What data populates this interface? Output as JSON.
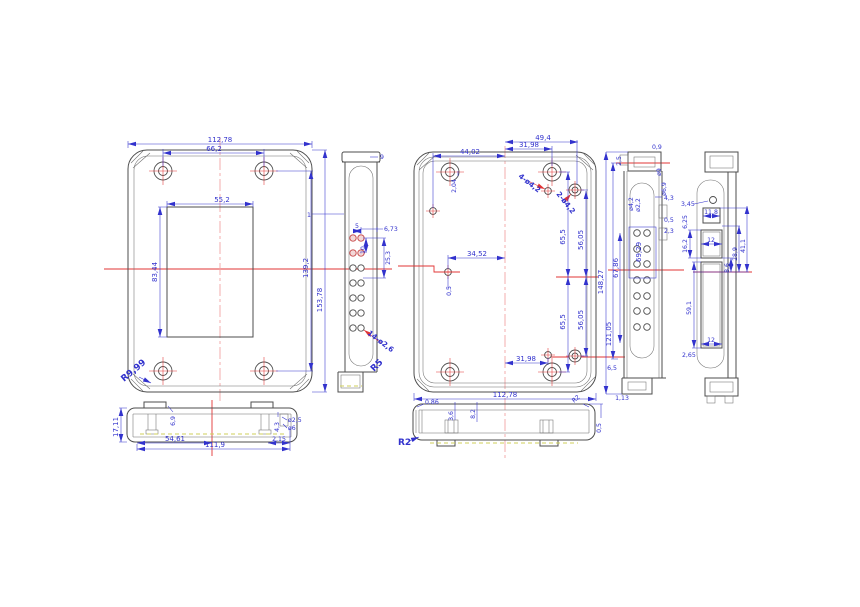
{
  "colors": {
    "background": "#ffffff",
    "outline": "#4d4d4d",
    "dimension_blue": "#3232cd",
    "centerline_pink": "#f2a4a4",
    "reference_red": "#e23434",
    "hidden_yellow": "#cfcf5a"
  },
  "views": {
    "front": {
      "labels": {
        "overall_width": "112,78",
        "hole_spacing": "66,2",
        "window_width": "55,2",
        "window_height": "83,44",
        "hole_span": "139,2",
        "overall_height": "153,78",
        "corner_radius": "R9,99"
      }
    },
    "left_section": {
      "labels": {
        "wall": "1",
        "cap": "9",
        "pitch_x": "5",
        "edge_offset": "6,73",
        "pitch_y": "10",
        "group_height": "25,3",
        "hole_note": "14-ø2,6",
        "corner_radius": "R5"
      }
    },
    "rear": {
      "labels": {
        "width_a": "44,02",
        "width_b": "31,98",
        "width_c": "49,4",
        "boss_offset": "2,04",
        "hole_note_a": "4-ø4,2",
        "hole_note_b": "2-ø4,2",
        "mid_width": "34,52",
        "mid_offset": "0,5",
        "upper_a": "65,5",
        "upper_b": "56,05",
        "lower_a": "65,5",
        "lower_b": "56,05",
        "width_bottom": "31,98",
        "overall_width": "112,78"
      }
    },
    "right_section": {
      "labels": {
        "cap_width": "2,5",
        "cap_lip": "0,9",
        "dia_a": "ø9",
        "dia_b": "ø6,9",
        "dia_c": "ø4,2",
        "dia_d": "ø2,2",
        "offset_a": "4,3",
        "offset_b": "0,5",
        "offset_c": "2,3",
        "group_width": "69,29",
        "hole_span": "67,86",
        "inner_height": "121,05",
        "overall_height": "148,27",
        "foot_offset": "6,5",
        "foot_lip": "1,13"
      }
    },
    "side": {
      "labels": {
        "hole_note": "3,45",
        "top_gap": "6,25",
        "slot1_width": "11,8",
        "slot2_height": "16,2",
        "slot2_width": "12",
        "span_a": "41,1",
        "span_b": "28,9",
        "gap": "8,6",
        "slot3_height": "59,1",
        "slot3_width": "12",
        "bottom_gap": "2,65"
      }
    },
    "bottom_left": {
      "labels": {
        "height": "17,11",
        "tab": "6,9",
        "step": "4,3",
        "dia_a": "ø2,5",
        "dia_b": "ø6",
        "half_width": "54,61",
        "overall_width": "111,9",
        "edge": "2,15"
      }
    },
    "bottom_center": {
      "labels": {
        "edge": "0,86",
        "rib_a": "3,6",
        "rib_b": "8,2",
        "radius": "R2",
        "corner": "R2",
        "lip": "0,5"
      }
    }
  }
}
